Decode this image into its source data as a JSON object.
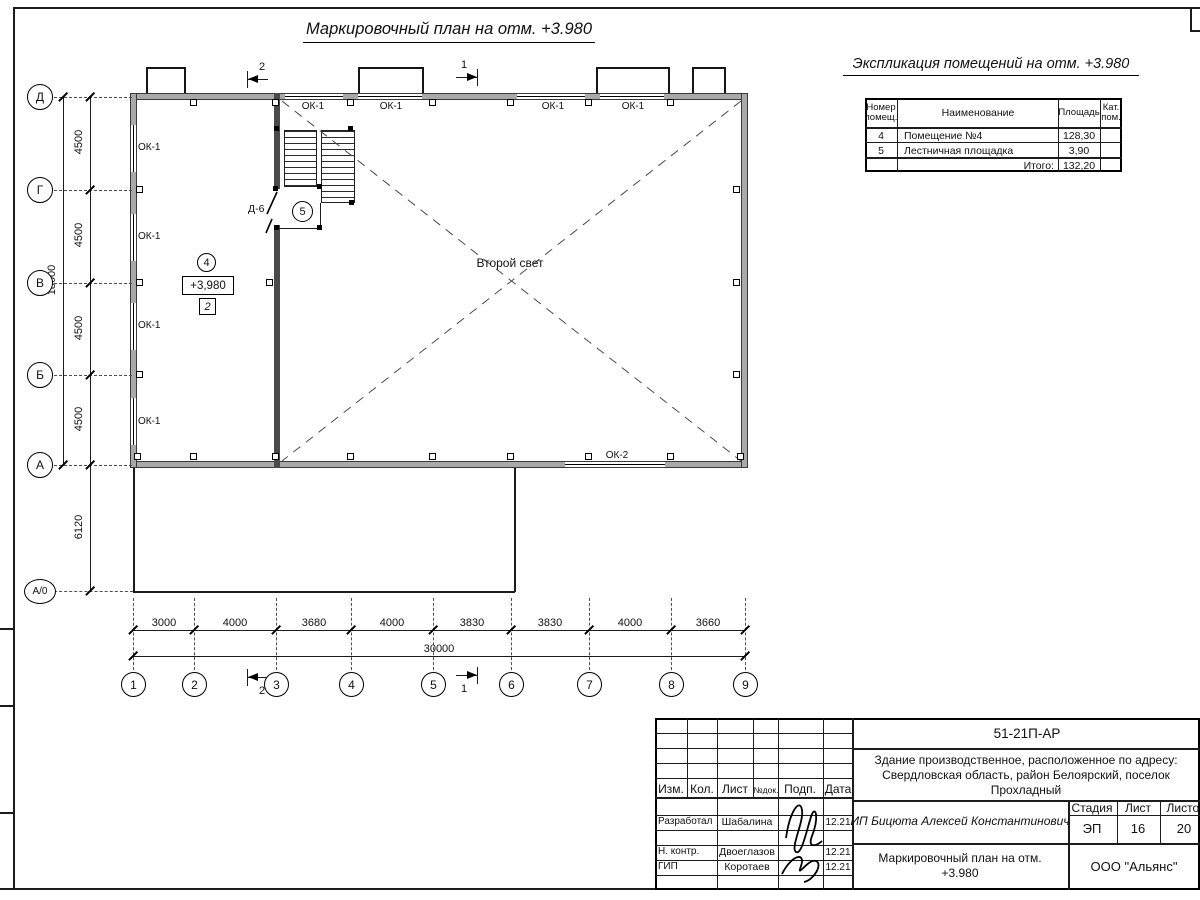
{
  "titles": {
    "plan_title": "Маркировочный план на отм. +3.980",
    "explication_title": "Экспликация помещений на отм. +3.980"
  },
  "explication": {
    "col_num_line1": "Номер",
    "col_num_line2": "помещ.",
    "col_name": "Наименование",
    "col_area": "Площадь",
    "col_cat_line1": "Кат.",
    "col_cat_line2": "пом.",
    "rows": [
      {
        "num": "4",
        "name": "Помещение №4",
        "area": "128,30"
      },
      {
        "num": "5",
        "name": "Лестничная площадка",
        "area": "3,90"
      }
    ],
    "total_label": "Итого:",
    "total_value": "132,20"
  },
  "plan": {
    "ok1": "ОК-1",
    "ok2": "ОК-2",
    "second_light": "Второй свет",
    "room4": "4",
    "room5": "5",
    "elevation": "+3,980",
    "zone": "2",
    "door": "Д-6",
    "section1": "1",
    "section2": "2"
  },
  "axes": {
    "h": [
      "1",
      "2",
      "3",
      "4",
      "5",
      "6",
      "7",
      "8",
      "9"
    ],
    "v": [
      "Д",
      "Г",
      "В",
      "Б",
      "А",
      "А/0"
    ]
  },
  "dims": {
    "bottom": [
      "3000",
      "4000",
      "3680",
      "4000",
      "3830",
      "3830",
      "4000",
      "3660"
    ],
    "bottom_total": "30000",
    "left": [
      "4500",
      "4500",
      "4500",
      "4500"
    ],
    "left_total": "18000",
    "left_lower": "6120"
  },
  "title_block": {
    "doc_number": "51-21П-АР",
    "project_line1": "Здание производственное, расположенное по адресу:",
    "project_line2": "Свердловская область, район Белоярский, поселок",
    "project_line3": "Прохладный",
    "client": "ИП Бицюта Алексей Константинович",
    "col_izm": "Изм.",
    "col_kol": "Кол.",
    "col_list": "Лист",
    "col_ndok": "№док.",
    "col_podp": "Подп.",
    "col_data": "Дата",
    "stage_label": "Стадия",
    "sheet_label": "Лист",
    "sheets_label": "Листов",
    "stage": "ЭП",
    "sheet": "16",
    "sheets": "20",
    "rows": [
      {
        "role": "Разработал",
        "name": "Шабалина",
        "date": "12.21"
      },
      {
        "role": "Н. контр.",
        "name": "Двоеглазов",
        "date": "12.21"
      },
      {
        "role": "ГИП",
        "name": "Коротаев",
        "date": "12.21"
      }
    ],
    "sheet_title_line1": "Маркировочный план на отм.",
    "sheet_title_line2": "+3.980",
    "company": "ООО \"Альянс\""
  }
}
